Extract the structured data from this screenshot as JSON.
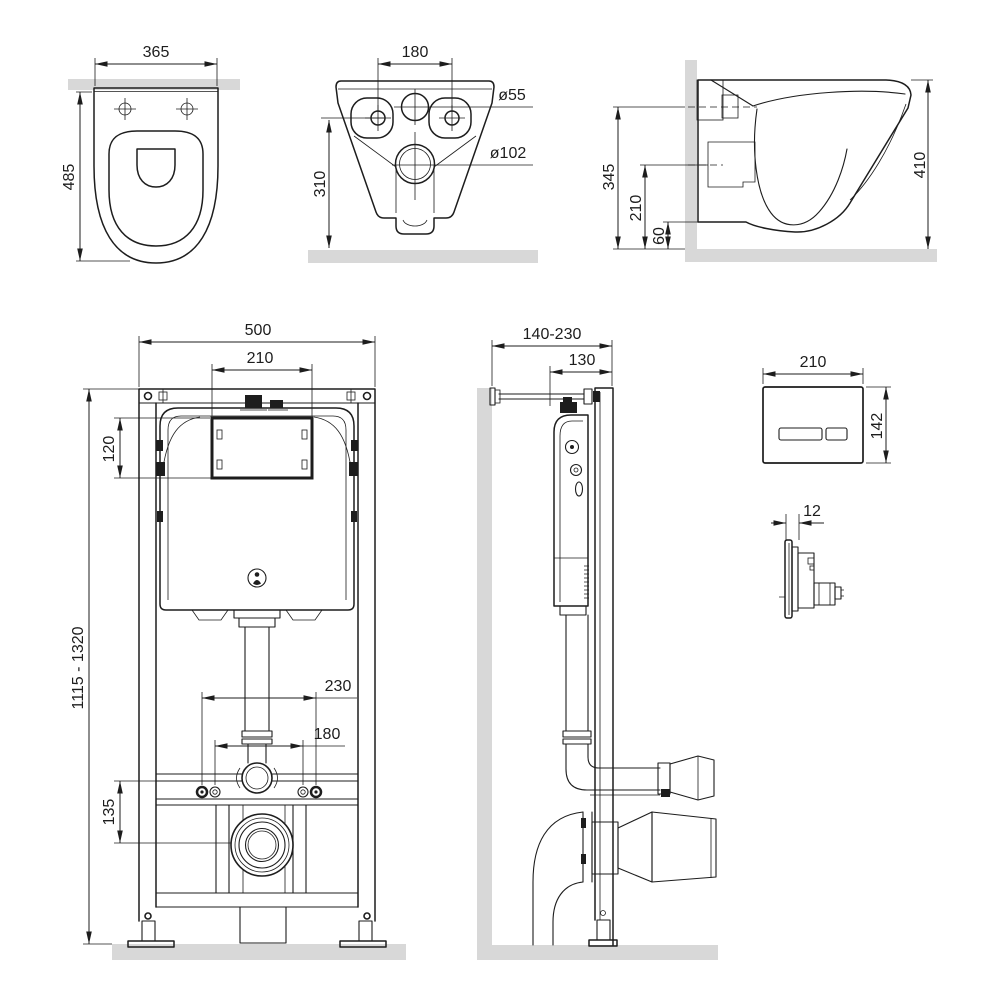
{
  "colors": {
    "line": "#1d1d1d",
    "surface": "#d8d8d8",
    "background": "#ffffff"
  },
  "views": {
    "toilet_top": {
      "dims": {
        "width": "365",
        "depth": "485"
      }
    },
    "toilet_rear": {
      "dims": {
        "bolt_spacing": "180",
        "inlet_diameter": "ø55",
        "outlet_diameter": "ø102",
        "height": "310"
      }
    },
    "toilet_side": {
      "dims": {
        "inlet_height": "345",
        "outlet_height": "210",
        "bottom_clearance": "60",
        "bowl_height": "410"
      }
    },
    "frame_front": {
      "dims": {
        "width": "500",
        "window_width": "210",
        "window_height": "120",
        "install_height": "1115 - 1320",
        "outer_stud_spacing": "230",
        "inner_stud_spacing": "180",
        "outlet_drop": "135"
      }
    },
    "frame_side": {
      "dims": {
        "wall_distance": "140-230",
        "frame_depth": "130"
      }
    },
    "flush_plate": {
      "dims": {
        "width": "210",
        "height": "142",
        "thickness": "12"
      }
    }
  }
}
